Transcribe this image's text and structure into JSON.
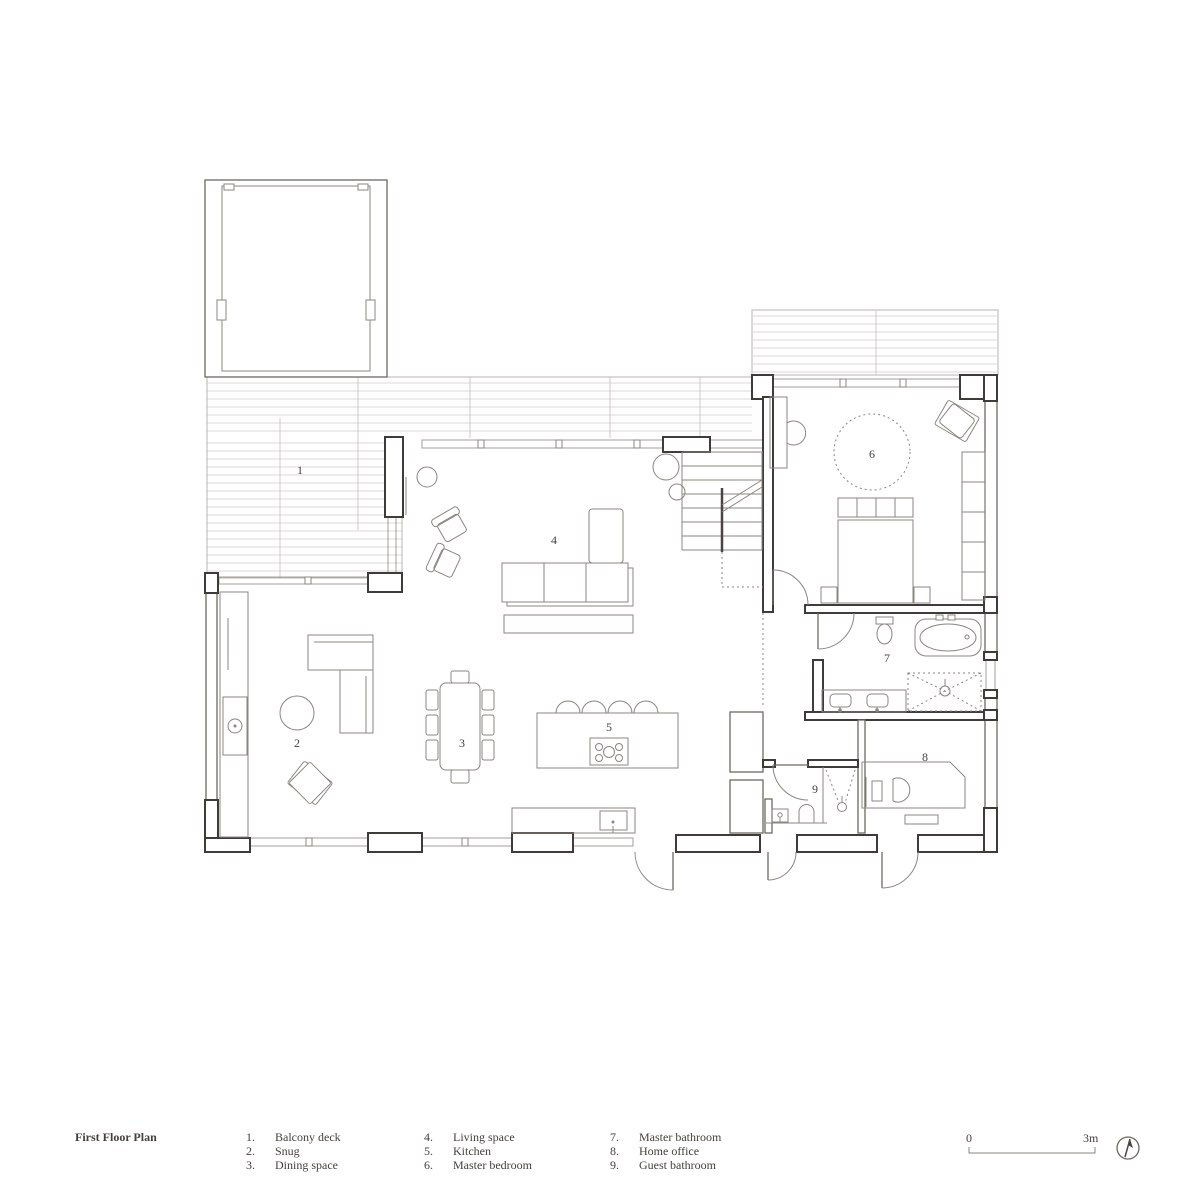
{
  "plan": {
    "title": "First Floor Plan",
    "rooms": [
      {
        "number": "1",
        "legend_label": "1.",
        "name": "Balcony deck"
      },
      {
        "number": "2",
        "legend_label": "2.",
        "name": "Snug"
      },
      {
        "number": "3",
        "legend_label": "3.",
        "name": "Dining space"
      },
      {
        "number": "4",
        "legend_label": "4.",
        "name": "Living space"
      },
      {
        "number": "5",
        "legend_label": "5.",
        "name": "Kitchen"
      },
      {
        "number": "6",
        "legend_label": "6.",
        "name": "Master bedroom"
      },
      {
        "number": "7",
        "legend_label": "7.",
        "name": "Master bathroom"
      },
      {
        "number": "8",
        "legend_label": "8.",
        "name": "Home office"
      },
      {
        "number": "9",
        "legend_label": "9.",
        "name": "Guest bathroom"
      }
    ]
  },
  "scale": {
    "start": "0",
    "end": "3m"
  },
  "colors": {
    "line": "#8b857f",
    "wall": "#3f3b38",
    "hatch": "#dcd9d5",
    "text": "#453e3a"
  }
}
